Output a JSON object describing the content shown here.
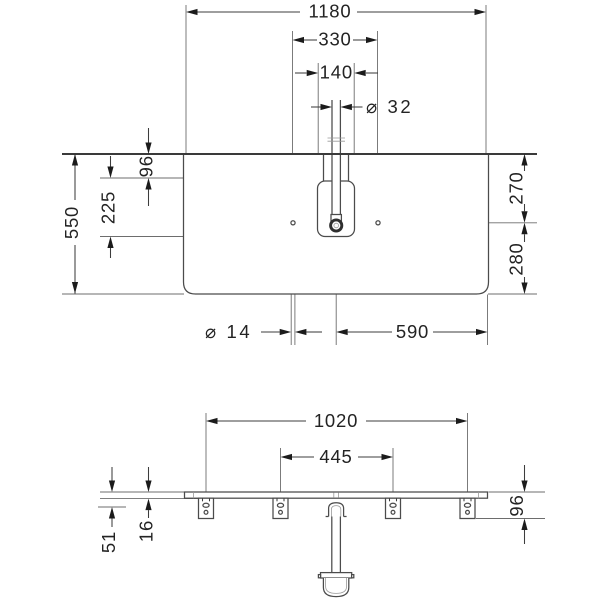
{
  "plan": {
    "width": "1180",
    "holeSpacing": "330",
    "cutoutWidth": "140",
    "faucetHole": "⌀ 32",
    "depth": "550",
    "edgeToCutout": "96",
    "cutoutDepth": "225",
    "rightUpper": "270",
    "rightLower": "280",
    "tapHole": "⌀ 14",
    "centerToEdge": "590"
  },
  "front": {
    "bracketSpan": "1020",
    "innerSpan": "445",
    "drop": "51",
    "thickness": "16",
    "bracketHeight": "96"
  },
  "colors": {
    "background": "#ffffff",
    "line": "#4b4b4b",
    "dimension": "#3d3d3d",
    "text": "#232323"
  }
}
